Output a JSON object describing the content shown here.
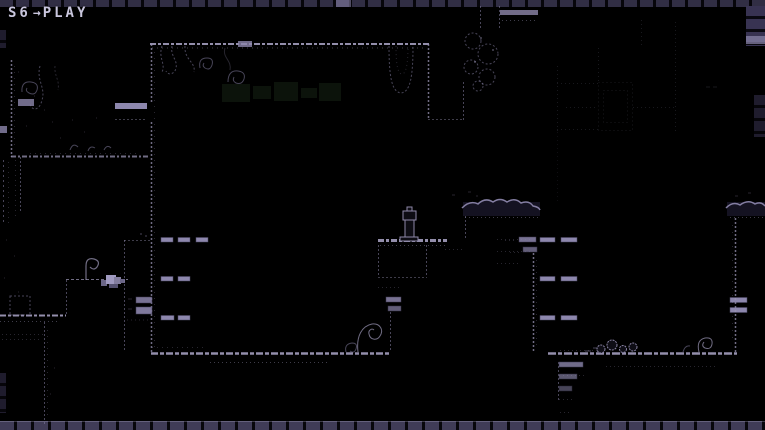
{
  "hud": {
    "state_label": "S6",
    "arrow_glyph": "→",
    "mode_label": "PLAY"
  },
  "icons": {
    "arrow": "arrow-right-icon"
  },
  "colors": {
    "background": "#000000",
    "hud_text": "#c9c6dd",
    "outline": "#9b95b6",
    "outline_strong": "#a39dbe",
    "outline_dim": "#837da0",
    "tile_light": "#8d87ad",
    "platform": "#8d87ad",
    "rock_fill": "#141221",
    "sign_green": "#0c130b",
    "sprite": "#a09ac0"
  }
}
